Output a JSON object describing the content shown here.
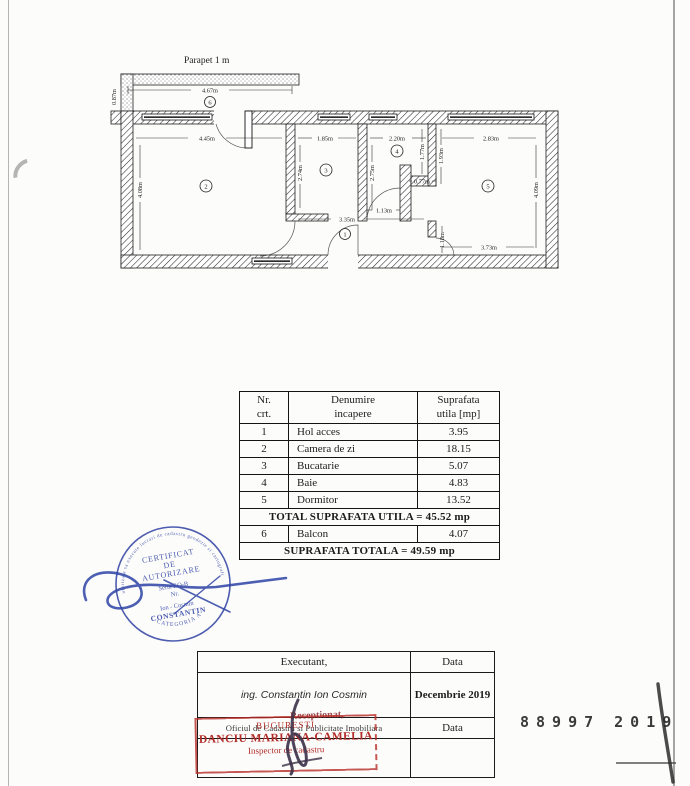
{
  "document": {
    "floor_plan": {
      "title": "Parapet 1 m",
      "room_numbers": [
        "1",
        "2",
        "3",
        "4",
        "5",
        "6"
      ],
      "dimensions": {
        "balcony_width": "4.67m",
        "balcony_depth": "0.87m",
        "room2_width": "4.45m",
        "room2_height": "4.08m",
        "room3_width": "1.85m",
        "room3_height": "2.74m",
        "room4_width": "2.20m",
        "room4_height": "2.75m",
        "room4_right": "1.77m",
        "room5_left": "1.93m",
        "notch_width": "0.77m",
        "door_width": "1.13m",
        "hall_width": "3.35m",
        "hall_height": "1.18m",
        "room5_width": "2.83m",
        "room5_height": "4.09m",
        "room5_bottom": "3.73m"
      }
    },
    "area_table": {
      "header": {
        "col1_line1": "Nr.",
        "col1_line2": "crt.",
        "col2_line1": "Denumire",
        "col2_line2": "incapere",
        "col3_line1": "Suprafata",
        "col3_line2": "utila [mp]"
      },
      "rows": [
        {
          "nr": "1",
          "name": "Hol acces",
          "area": "3.95"
        },
        {
          "nr": "2",
          "name": "Camera de zi",
          "area": "18.15"
        },
        {
          "nr": "3",
          "name": "Bucatarie",
          "area": "5.07"
        },
        {
          "nr": "4",
          "name": "Baie",
          "area": "4.83"
        },
        {
          "nr": "5",
          "name": "Dormitor",
          "area": "13.52"
        }
      ],
      "total_utila": "TOTAL SUPRAFATA UTILA = 45.52 mp",
      "balcony_row": {
        "nr": "6",
        "name": "Balcon",
        "area": "4.07"
      },
      "total_general": "SUPRAFATA TOTALA = 49.59 mp"
    },
    "authorization_stamp": {
      "arc_top": "autorizata sa execute lucrari de cadastru geodezie si cartografie",
      "line1": "CERTIFICAT",
      "line2": "DE",
      "line3": "AUTORIZARE",
      "line4": "Seria RO-B",
      "line5": "Nr.",
      "line6": "Ion - Cosmin",
      "line7": "CONSTANTIN",
      "arc_bottom": "CATEGORIA A",
      "ink_color": "#3547a5"
    },
    "signature_block": {
      "executant_label": "Executant,",
      "executant_name": "ing. Constantin Ion Cosmin",
      "data_label_1": "Data",
      "data_value_1": "Decembrie 2019",
      "office_line": "Oficiul de Cadastru si Publicitate Imobiliara",
      "receptionat": "Receptionat,",
      "data_label_2": "Data"
    },
    "inspector_stamp": {
      "city": "BUCURESTI",
      "name": "DANCIU MARIANA-CAMELIA",
      "title": "Inspector de cadastru",
      "ink_color": "#b22c28"
    },
    "registration_number": {
      "part1": "88997",
      "part2": "2019"
    }
  }
}
